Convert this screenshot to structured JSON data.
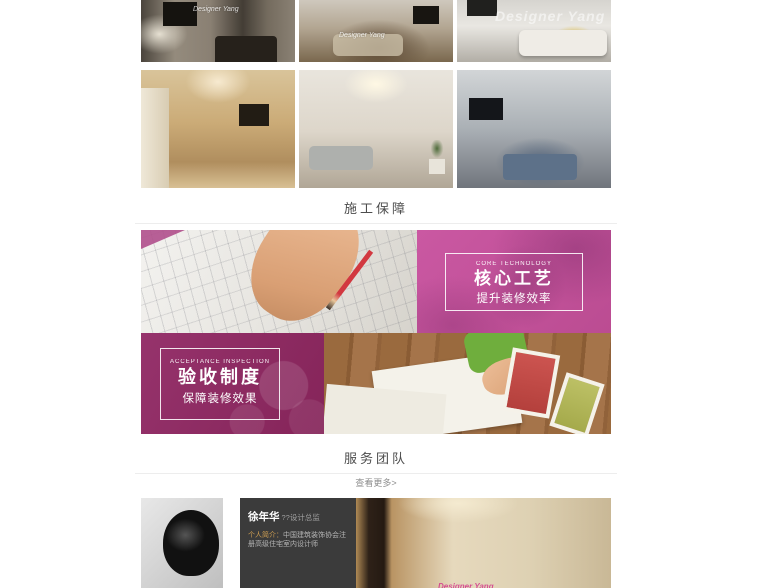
{
  "gallery": {
    "watermark_text": "Designer Yang"
  },
  "construction_section": {
    "title": "施工保障",
    "banners": {
      "core": {
        "tag": "CORE TECHNOLOGY",
        "heading": "核心工艺",
        "subheading": "提升装修效率",
        "accent_color": "#c0519a"
      },
      "acceptance": {
        "tag": "ACCEPTANCE INSPECTION",
        "heading": "验收制度",
        "subheading": "保障装修效果",
        "accent_color": "#8e2a62"
      }
    }
  },
  "team_section": {
    "title": "服务团队",
    "view_more": "查看更多>",
    "member": {
      "name": "徐年华",
      "title_suffix": "??设计总监",
      "bio_label": "个人简介：",
      "bio_text": "中国建筑装饰协会注册高级住宅室内设计师"
    },
    "panel_color": "#3b3b3b"
  }
}
